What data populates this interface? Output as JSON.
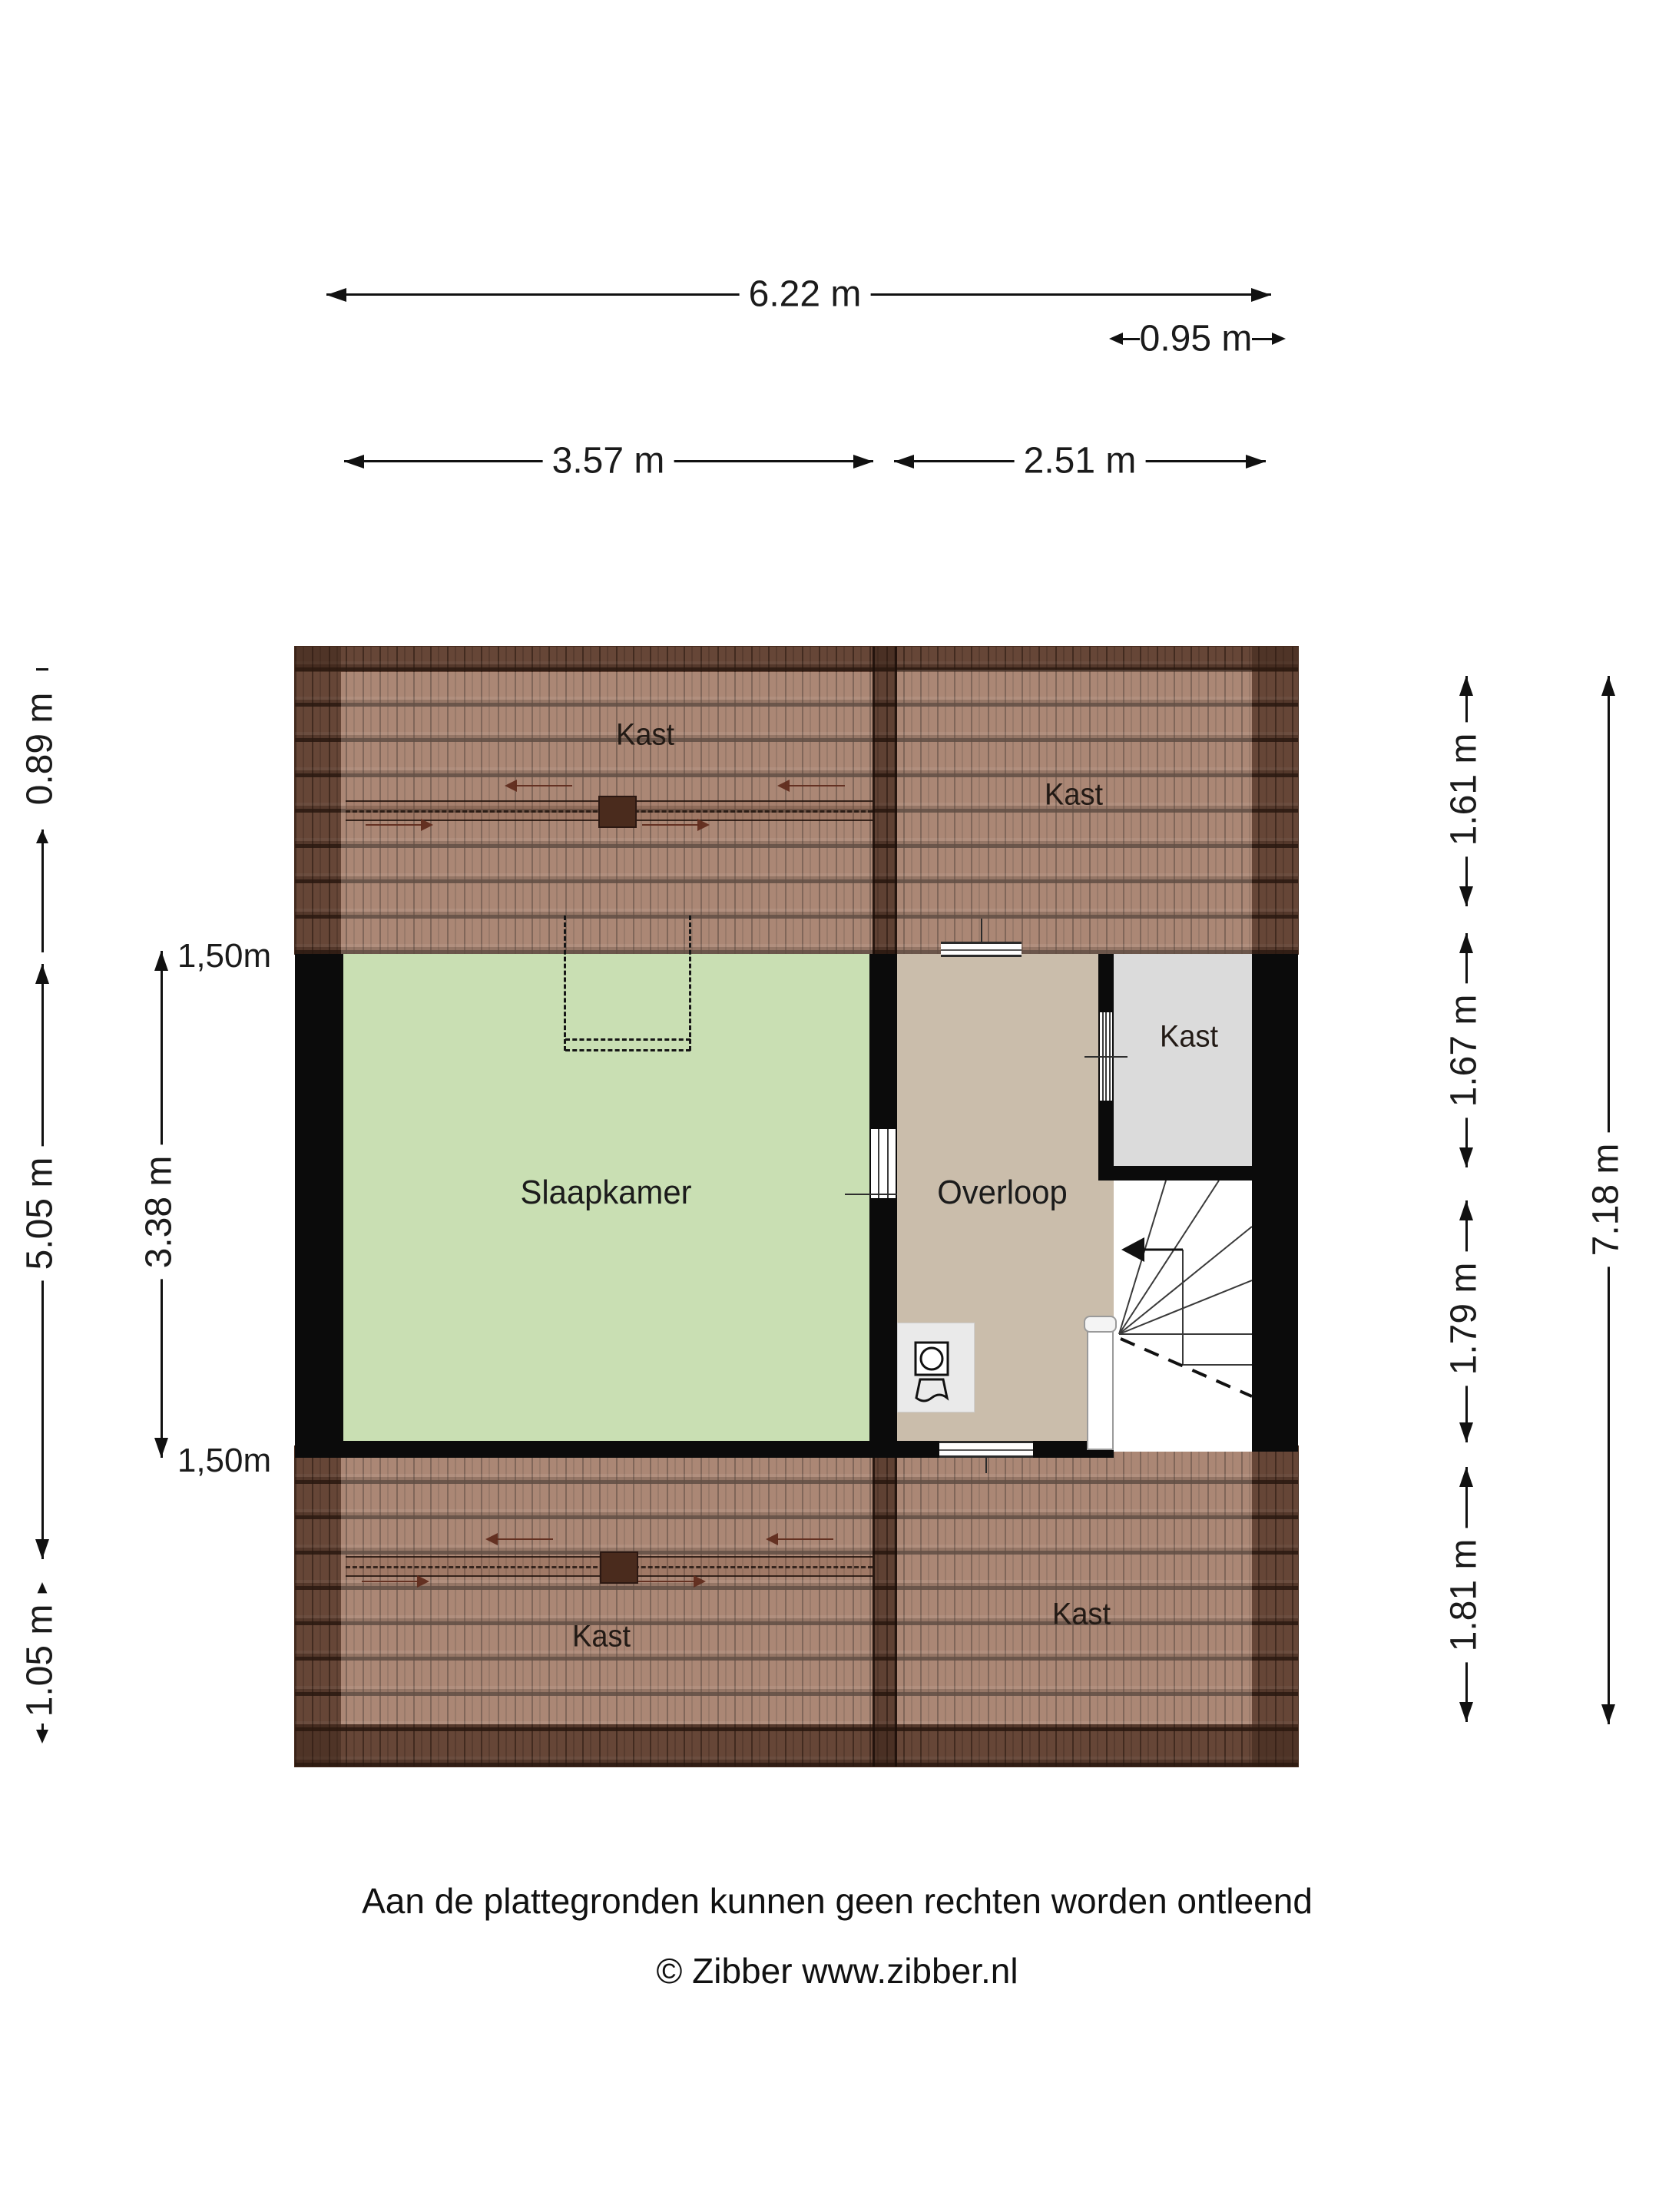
{
  "page": {
    "background": "#ffffff"
  },
  "floor_plan": {
    "rooms": [
      {
        "id": "kast-top-left",
        "label": "Kast"
      },
      {
        "id": "kast-top-right",
        "label": "Kast"
      },
      {
        "id": "slaapkamer",
        "label": "Slaapkamer"
      },
      {
        "id": "overloop",
        "label": "Overloop"
      },
      {
        "id": "kast-middle",
        "label": "Kast"
      },
      {
        "id": "kast-bottom-left",
        "label": "Kast"
      },
      {
        "id": "kast-bottom-right",
        "label": "Kast"
      }
    ],
    "colors": {
      "roof_tile": "#8d6553",
      "roof_dark_edge": "#5d3c2c",
      "bedroom_green": "#c9dfb3",
      "landing_tan": "#cabdab",
      "closet_gray": "#dbdbdb",
      "wall_black": "#0b0b0b"
    }
  },
  "dimensions": {
    "top_total": "6.22 m",
    "top_offset": "0.95 m",
    "top_left": "3.57 m",
    "top_right": "2.51 m",
    "left_roof_top": "0.89 m",
    "left_total": "5.05 m",
    "left_roof_bottom": "1.05 m",
    "left_knee_top": "1,50m",
    "left_room": "3.38 m",
    "left_knee_bottom": "1,50m",
    "right_roof_top": "1.61 m",
    "right_closet": "1.67 m",
    "right_landing": "1.79 m",
    "right_roof_bottom": "1.81 m",
    "right_total": "7.18 m"
  },
  "icons": {
    "washing_machine": "washing-machine-icon",
    "stairs_direction": "stairs-direction-arrow-icon",
    "roof_window_arrows": "roof-window-arrow-icon"
  },
  "footer": {
    "disclaimer": "Aan de plattegronden kunnen geen rechten worden ontleend",
    "copyright": "© Zibber www.zibber.nl"
  }
}
